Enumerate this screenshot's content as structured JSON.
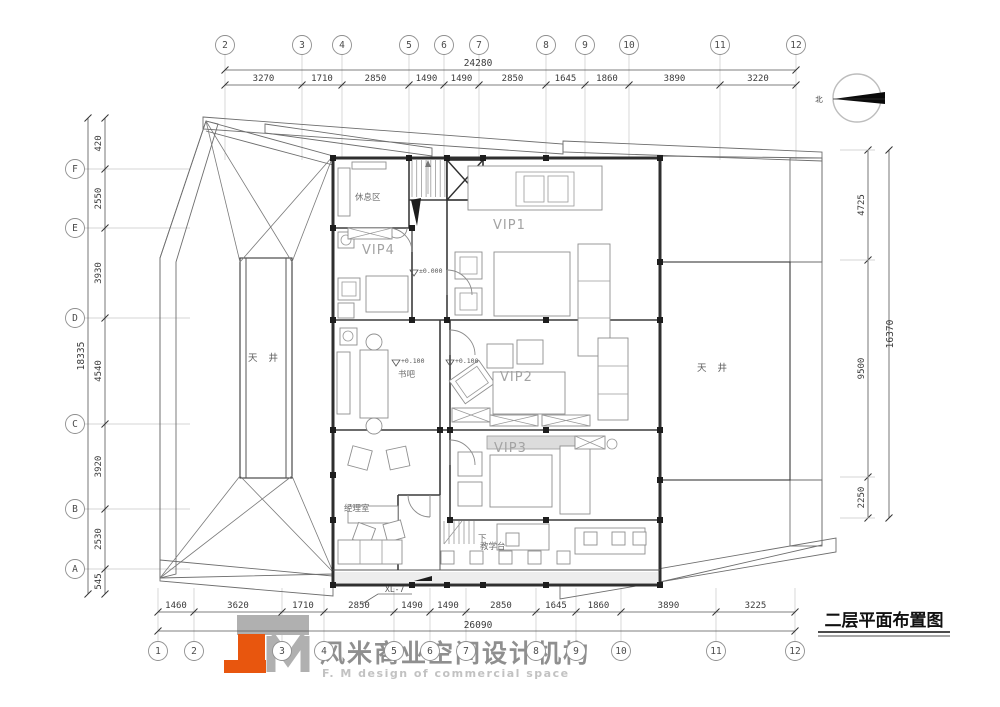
{
  "title": {
    "text": "二层平面布置图"
  },
  "logo": {
    "cn": "风米商业空间设计机构",
    "en": "F. M design of commercial space",
    "orange": "#e8560e",
    "grey": "#b0b0b0"
  },
  "north": {
    "label": "北"
  },
  "plan": {
    "rooms": [
      {
        "key": "rest-area",
        "label": "休息区"
      },
      {
        "key": "vip1",
        "label": "VIP1"
      },
      {
        "key": "vip4",
        "label": "VIP4"
      },
      {
        "key": "book-bar",
        "label": "书吧"
      },
      {
        "key": "vip2",
        "label": "VIP2"
      },
      {
        "key": "vip3",
        "label": "VIP3"
      },
      {
        "key": "manager-office",
        "label": "经理室"
      },
      {
        "key": "teaching-counter",
        "label": "教学台"
      },
      {
        "key": "courtyard-left",
        "label": "天 井"
      },
      {
        "key": "courtyard-right",
        "label": "天 井"
      }
    ],
    "levels": {
      "corridor": "±0.000",
      "book_bar": "+0.100",
      "vip2": "+0.100"
    },
    "stair_down_label": "下",
    "detail_ref": "XL-7"
  },
  "grids": {
    "top": {
      "labels": [
        "2",
        "3",
        "4",
        "5",
        "6",
        "7",
        "8",
        "9",
        "10",
        "11",
        "12"
      ],
      "segments": [
        "3270",
        "1710",
        "2850",
        "1490",
        "1490",
        "2850",
        "1645",
        "1860",
        "3890",
        "3220"
      ],
      "total": "24280"
    },
    "bottom": {
      "labels": [
        "1",
        "2",
        "3",
        "4",
        "5",
        "6",
        "7",
        "8",
        "9",
        "10",
        "11",
        "12"
      ],
      "segments": [
        "1460",
        "3620",
        "1710",
        "2850",
        "1490",
        "1490",
        "2850",
        "1645",
        "1860",
        "3890",
        "3225"
      ],
      "total": "26090"
    },
    "left": {
      "labels": [
        "F",
        "E",
        "D",
        "C",
        "B",
        "A"
      ],
      "segments": [
        "420",
        "2550",
        "3930",
        "4540",
        "3920",
        "2530",
        "545"
      ],
      "total": "18335"
    },
    "right": {
      "segments": [
        "4725",
        "9500",
        "2250"
      ],
      "total": "16370"
    }
  }
}
